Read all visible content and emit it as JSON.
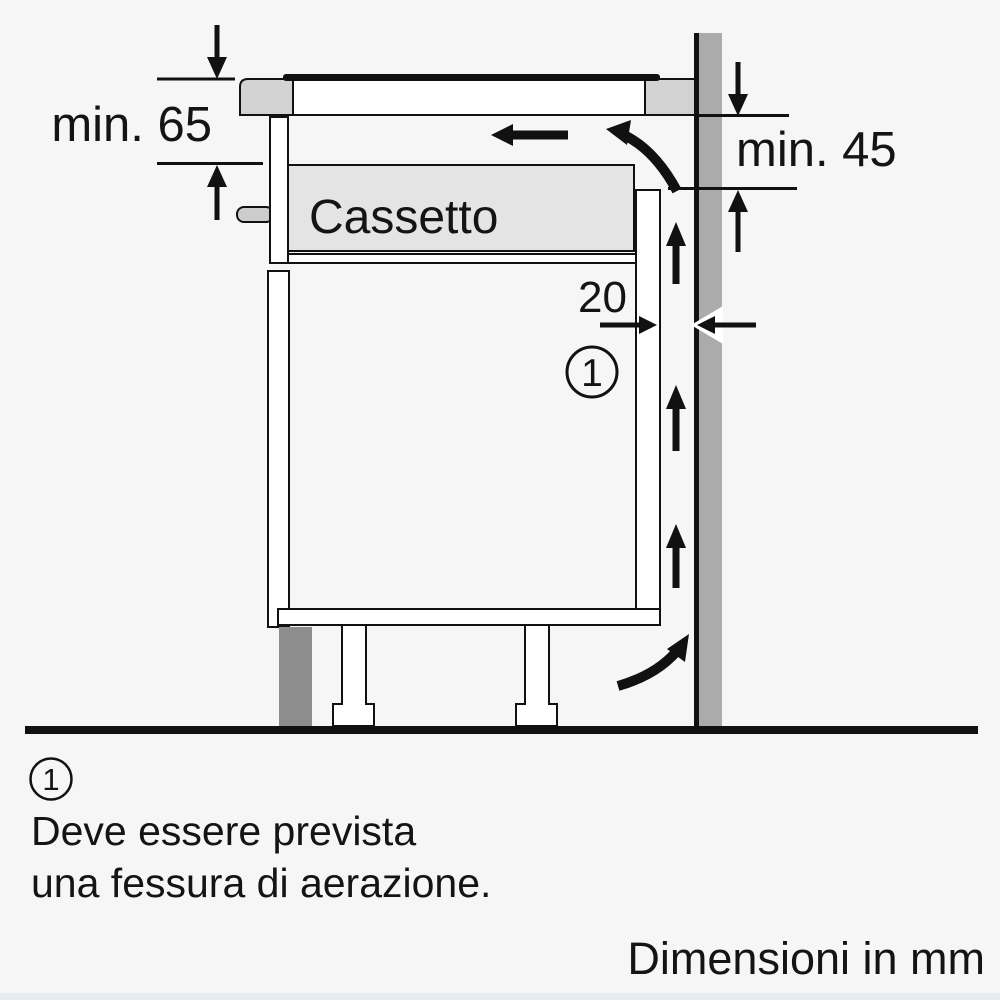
{
  "diagram": {
    "dimension_labels": {
      "hob_top_clearance": "min. 65",
      "under_worktop_clearance": "min. 45",
      "rear_gap_width": "20"
    },
    "drawer_label": "Cassetto",
    "callout_marker": "1",
    "colors": {
      "background": "#f6f6f6",
      "line": "#111111",
      "wall": "#ababab",
      "plinth": "#8d8d8d",
      "worktop": "#d2d2d2",
      "drawer_fill": "#e4e4e4",
      "handle_fill": "#cccccc",
      "footer_strip": "#e6ebf0"
    }
  },
  "note": {
    "marker": "1",
    "line1": "Deve essere prevista",
    "line2": "una fessura di aerazione."
  },
  "footer": {
    "units_note": "Dimensioni in mm"
  }
}
